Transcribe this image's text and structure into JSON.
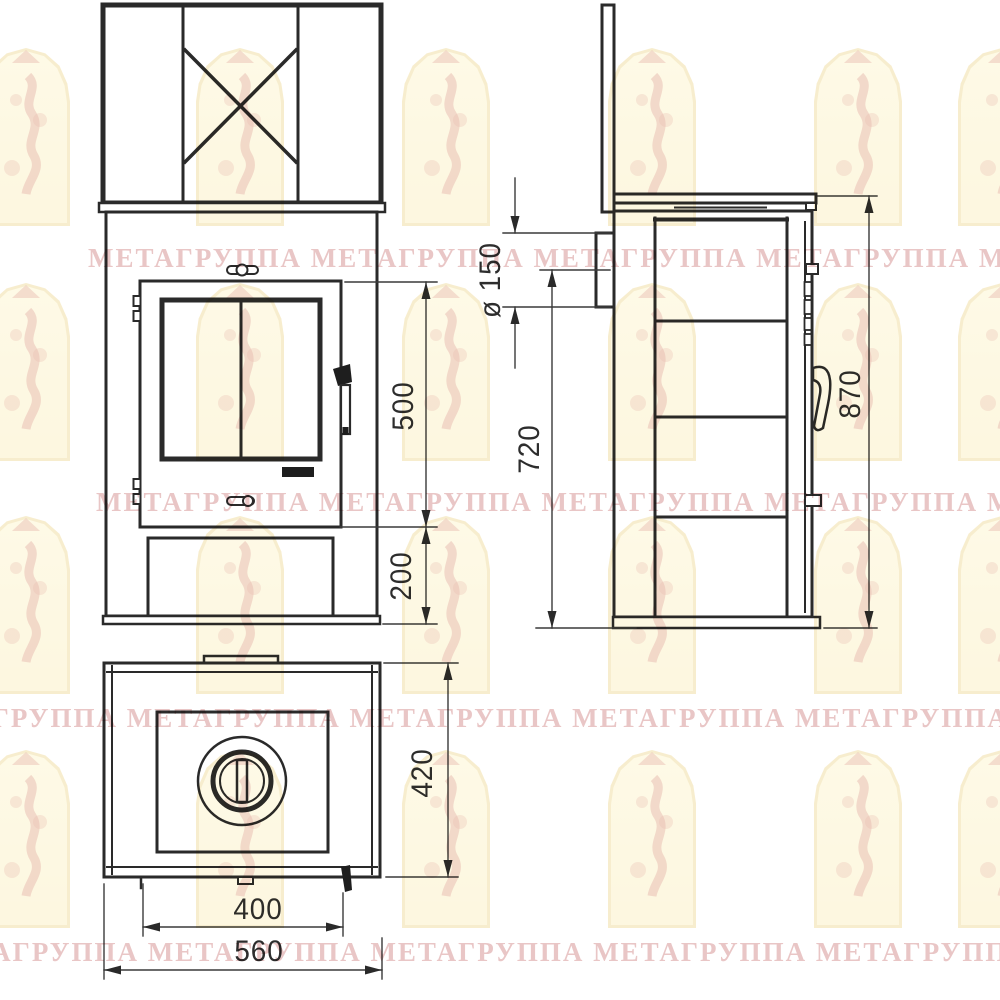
{
  "watermark": {
    "text": "МЕТАГРУППА",
    "row_repeat": "МЕТАГРУППА МЕТАГРУППА МЕТАГРУППА МЕТАГРУППА МЕТАГРУППА"
  },
  "dimensions": {
    "door_height": "500",
    "lower_height": "200",
    "flue_diameter": "ø 150",
    "flue_axis_height": "720",
    "overall_height": "870",
    "depth": "420",
    "inner_width": "400",
    "overall_width": "560"
  },
  "colors": {
    "line": "#2a2a2a",
    "watermark_text": "#e5bcbc",
    "arch_fill": "#fdf6d2",
    "arch_border": "#f0dfa6",
    "arch_figure": "#d4826e"
  }
}
